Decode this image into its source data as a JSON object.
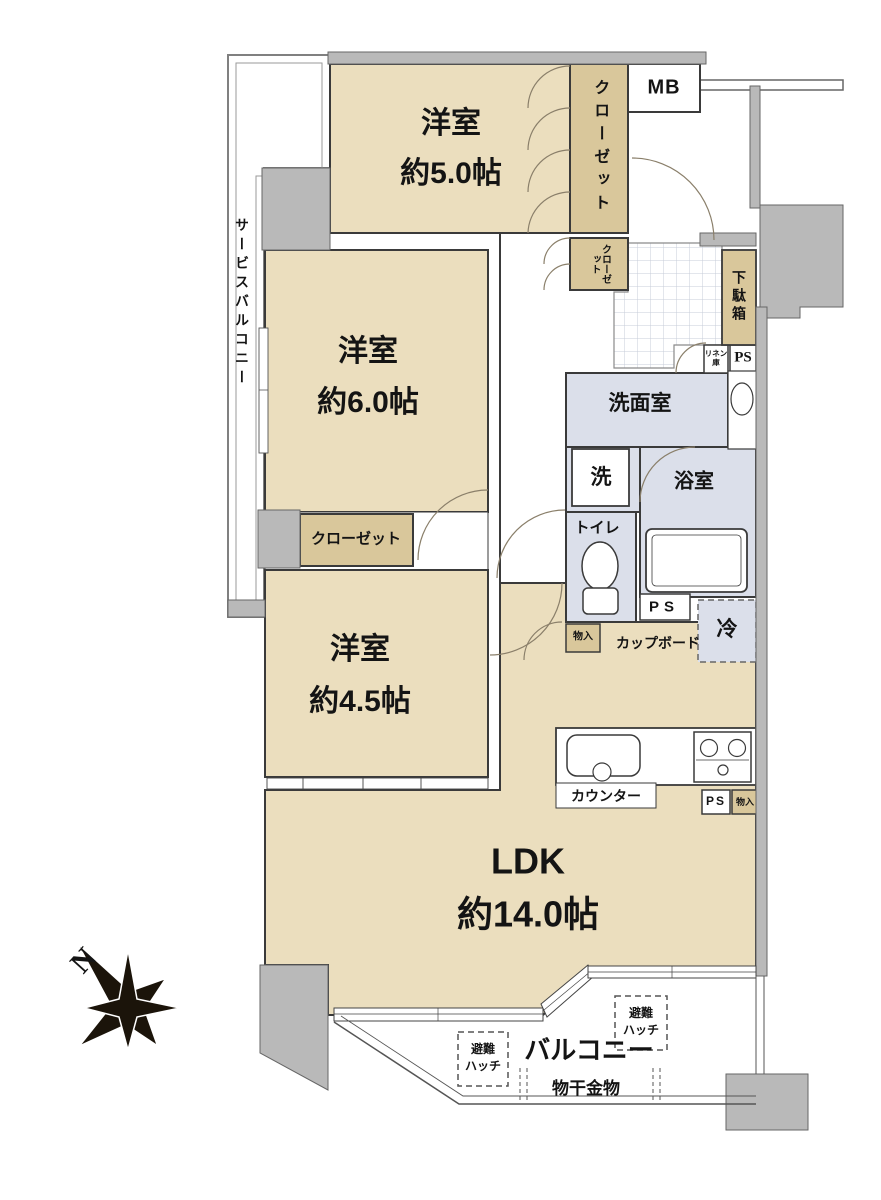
{
  "floorplan": {
    "compass": {
      "north_label": "N"
    },
    "colors": {
      "room_fill": "#EBDEBE",
      "closet_fill": "#D9C79B",
      "wet_area_fill": "#DBDFEA",
      "wall_gray": "#B9B9B9",
      "line": "#3A3A3A"
    },
    "rooms": {
      "bedroom_a": {
        "name": "洋室",
        "area": "約5.0帖"
      },
      "bedroom_b": {
        "name": "洋室",
        "area": "約6.0帖"
      },
      "bedroom_c": {
        "name": "洋室",
        "area": "約4.5帖"
      },
      "ldk": {
        "name": "LDK",
        "area": "約14.0帖"
      },
      "washroom": {
        "name": "洗面室"
      },
      "bathroom": {
        "name": "浴室"
      },
      "toilet": {
        "name": "トイレ"
      },
      "service_balcony": {
        "name": "サービスバルコニー"
      },
      "balcony": {
        "name": "バルコニー"
      }
    },
    "storage": {
      "closet_bedroom_a": "クローゼット",
      "closet_entry_small": "クローゼット",
      "closet_bedroom_b": "クローゼット",
      "shoe_cabinet": "下駄箱",
      "linen_line1": "リネン",
      "linen_line2": "庫",
      "storage_hall": "物入",
      "storage_kitchen": "物入",
      "cupboard": "カップボード"
    },
    "kitchen": {
      "counter": "カウンター"
    },
    "appliances": {
      "washer": "洗",
      "fridge": "冷"
    },
    "utilities": {
      "meter_box": "MB",
      "pipe_space_entry": "PS",
      "pipe_space_bath": "PS",
      "pipe_space_kitchen": "PS"
    },
    "balcony_items": {
      "hatch1_line1": "避難",
      "hatch1_line2": "ハッチ",
      "hatch2_line1": "避難",
      "hatch2_line2": "ハッチ",
      "laundry_hardware": "物干金物"
    }
  }
}
